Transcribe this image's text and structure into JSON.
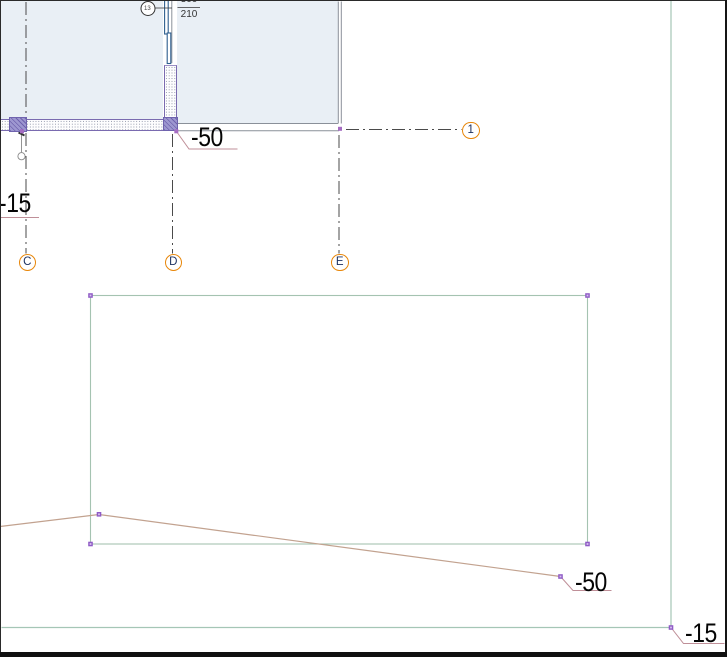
{
  "canvas": {
    "description": "CAD drawing canvas with plan fragment, grid axes, zone rectangle and terrain line"
  },
  "grid": {
    "bubbles": [
      {
        "label": "C"
      },
      {
        "label": "D"
      },
      {
        "label": "E"
      },
      {
        "label": "1"
      }
    ]
  },
  "elevations": {
    "wall_corner": "-50",
    "left_wall": "-15",
    "terrain_end": "-50",
    "bottom_right": "-15"
  },
  "door_tag": {
    "id": "13",
    "dim_top": "300",
    "dim_bottom": "210"
  },
  "colors": {
    "room_fill": "#e9eff5",
    "wall_outline": "#7a6bb0",
    "block_fill": "#9d97d0",
    "grid_bubble": "#e8870a",
    "grid_letter": "#1b2f5e",
    "gridline": "#4a4a4a",
    "guide_teal": "#a5c6b6",
    "zone_rect": "#a5c3b1",
    "terrain": "#c2a28f",
    "leader": "#bf8f98",
    "handle": "#8f5bc6",
    "door": "#2e5e8e"
  }
}
